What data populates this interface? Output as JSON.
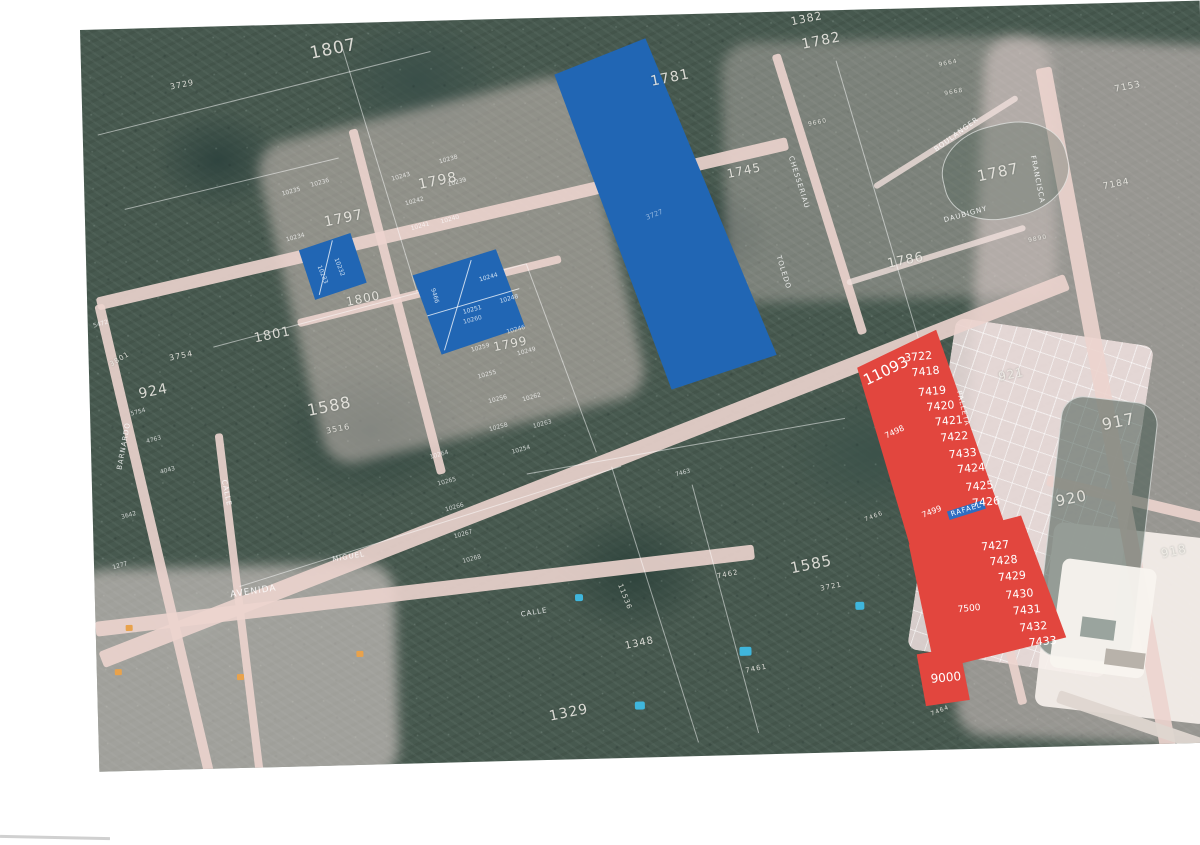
{
  "colors": {
    "highlight_red": "#e2463e",
    "highlight_blue": "#2166b4",
    "road_pink": "#ecd4ce",
    "street_banner_blue": "#2e6ec2",
    "label_white": "#ffffff",
    "forest_green": "#47594f"
  },
  "highlights": {
    "blue_parcels": {
      "large_parcel": "3727",
      "small_group_a": [
        "10233",
        "10232"
      ],
      "small_group_b": [
        "9466",
        "10244",
        "10251",
        "10248"
      ]
    },
    "red_parcels": {
      "side_labels": [
        "11093",
        "7498",
        "7499",
        "7500"
      ],
      "upper_column": [
        "3722",
        "7418",
        "7419",
        "7420",
        "7421",
        "7422",
        "7433",
        "7424",
        "7425",
        "7426"
      ],
      "lower_column": [
        "7427",
        "7428",
        "7429",
        "7430",
        "7431",
        "7432",
        "7433"
      ],
      "bottom_lot": "9000",
      "street_banner": "RAFAEL"
    }
  },
  "map_labels": [
    {
      "t": "1807",
      "k": "parcel",
      "x": 228,
      "y": 22,
      "s": 17
    },
    {
      "t": "3729",
      "k": "parcel",
      "x": 88,
      "y": 56,
      "s": 8
    },
    {
      "t": "1798",
      "k": "parcel",
      "x": 333,
      "y": 157,
      "s": 14
    },
    {
      "t": "1797",
      "k": "parcel",
      "x": 238,
      "y": 192,
      "s": 14
    },
    {
      "t": "1782",
      "k": "parcel",
      "x": 720,
      "y": 27,
      "s": 14
    },
    {
      "t": "1382",
      "k": "parcel",
      "x": 710,
      "y": 5,
      "s": 11
    },
    {
      "t": "1781",
      "k": "parcel",
      "x": 568,
      "y": 60,
      "s": 14
    },
    {
      "t": "1745",
      "k": "parcel",
      "x": 642,
      "y": 155,
      "s": 12
    },
    {
      "t": "1787",
      "k": "parcel",
      "x": 892,
      "y": 163,
      "s": 15
    },
    {
      "t": "1786",
      "k": "parcel",
      "x": 800,
      "y": 249,
      "s": 13
    },
    {
      "t": "7153",
      "k": "parcel",
      "x": 1032,
      "y": 83,
      "s": 9
    },
    {
      "t": "7184",
      "k": "parcel",
      "x": 1018,
      "y": 180,
      "s": 9
    },
    {
      "t": "917",
      "k": "parcel",
      "x": 1010,
      "y": 414,
      "s": 16
    },
    {
      "t": "921",
      "k": "parcel",
      "x": 908,
      "y": 365,
      "s": 12
    },
    {
      "t": "920",
      "k": "parcel",
      "x": 962,
      "y": 490,
      "s": 15
    },
    {
      "t": "918",
      "k": "parcel",
      "x": 1066,
      "y": 546,
      "s": 12
    },
    {
      "t": "924",
      "k": "parcel",
      "x": 48,
      "y": 359,
      "s": 14
    },
    {
      "t": "3754",
      "k": "parcel",
      "x": 80,
      "y": 327,
      "s": 8
    },
    {
      "t": "3801",
      "k": "parcel",
      "x": 20,
      "y": 333,
      "s": 7,
      "r": -30
    },
    {
      "t": "1801",
      "k": "parcel",
      "x": 165,
      "y": 307,
      "s": 13
    },
    {
      "t": "1800",
      "k": "parcel",
      "x": 258,
      "y": 273,
      "s": 12
    },
    {
      "t": "1799",
      "k": "parcel",
      "x": 404,
      "y": 322,
      "s": 12
    },
    {
      "t": "1588",
      "k": "parcel",
      "x": 216,
      "y": 379,
      "s": 16
    },
    {
      "t": "3516",
      "k": "parcel",
      "x": 235,
      "y": 404,
      "s": 8
    },
    {
      "t": "1585",
      "k": "parcel",
      "x": 695,
      "y": 550,
      "s": 15
    },
    {
      "t": "3721",
      "k": "parcel",
      "x": 725,
      "y": 575,
      "s": 7
    },
    {
      "t": "7462",
      "k": "parcel",
      "x": 622,
      "y": 560,
      "s": 7
    },
    {
      "t": "7461",
      "k": "parcel",
      "x": 648,
      "y": 655,
      "s": 7
    },
    {
      "t": "11536",
      "k": "parcel",
      "x": 528,
      "y": 567,
      "s": 7,
      "r": 70
    },
    {
      "t": "1329",
      "k": "parcel",
      "x": 450,
      "y": 692,
      "s": 14
    },
    {
      "t": "1348",
      "k": "parcel",
      "x": 528,
      "y": 626,
      "s": 10
    },
    {
      "t": "7464",
      "k": "parcel",
      "x": 832,
      "y": 704,
      "s": 6,
      "r": -20
    },
    {
      "t": "7466",
      "k": "parcel",
      "x": 771,
      "y": 508,
      "s": 6,
      "r": -20
    },
    {
      "t": "9890",
      "k": "parcel",
      "x": 942,
      "y": 233,
      "s": 6
    },
    {
      "t": "9664",
      "k": "parcel",
      "x": 857,
      "y": 55,
      "s": 6
    },
    {
      "t": "9668",
      "k": "parcel",
      "x": 862,
      "y": 84,
      "s": 6
    },
    {
      "t": "9660",
      "k": "parcel",
      "x": 725,
      "y": 111,
      "s": 6
    },
    {
      "t": "BOULANGER",
      "k": "street",
      "x": 850,
      "y": 140,
      "r": -35
    },
    {
      "t": "DAUBIGNY",
      "k": "street",
      "x": 858,
      "y": 210,
      "r": -14
    },
    {
      "t": "CHESSERIAU",
      "k": "street",
      "x": 710,
      "y": 144,
      "r": 74
    },
    {
      "t": "TOLEDO",
      "k": "street",
      "x": 695,
      "y": 243,
      "r": 74
    },
    {
      "t": "FRANCISCA",
      "k": "street",
      "x": 952,
      "y": 150,
      "r": 80
    },
    {
      "t": "PALLETA",
      "k": "street",
      "x": 872,
      "y": 383,
      "r": 78
    },
    {
      "t": "BARNARDO",
      "k": "street",
      "x": 25,
      "y": 440,
      "r": -78
    },
    {
      "t": "CALLE",
      "k": "street",
      "x": 135,
      "y": 453,
      "r": 80
    },
    {
      "t": "CALLE",
      "k": "street",
      "x": 425,
      "y": 593,
      "r": -8
    },
    {
      "t": "AVENIDA",
      "k": "street",
      "x": 135,
      "y": 565,
      "r": -7,
      "s": 9
    },
    {
      "t": "MIGUEL",
      "k": "street",
      "x": 238,
      "y": 533,
      "r": -8
    },
    {
      "t": "RAFAEL",
      "k": "banner",
      "x": 854,
      "y": 504,
      "r": -16
    },
    {
      "t": "10243",
      "k": "tiny",
      "x": 307,
      "y": 155
    },
    {
      "t": "10238",
      "k": "tiny",
      "x": 355,
      "y": 139
    },
    {
      "t": "10242",
      "k": "tiny",
      "x": 320,
      "y": 180
    },
    {
      "t": "10239",
      "k": "tiny",
      "x": 363,
      "y": 162
    },
    {
      "t": "10240",
      "k": "tiny",
      "x": 355,
      "y": 199
    },
    {
      "t": "10241",
      "k": "tiny",
      "x": 325,
      "y": 205
    },
    {
      "t": "10236",
      "k": "tiny",
      "x": 226,
      "y": 159
    },
    {
      "t": "10235",
      "k": "tiny",
      "x": 197,
      "y": 167
    },
    {
      "t": "10234",
      "k": "tiny",
      "x": 200,
      "y": 213
    },
    {
      "t": "10260",
      "k": "tiny",
      "x": 375,
      "y": 300
    },
    {
      "t": "10246",
      "k": "tiny",
      "x": 418,
      "y": 311
    },
    {
      "t": "10259",
      "k": "tiny",
      "x": 382,
      "y": 328
    },
    {
      "t": "10249",
      "k": "tiny",
      "x": 428,
      "y": 333
    },
    {
      "t": "10255",
      "k": "tiny",
      "x": 388,
      "y": 355
    },
    {
      "t": "10256",
      "k": "tiny",
      "x": 398,
      "y": 380
    },
    {
      "t": "10262",
      "k": "tiny",
      "x": 432,
      "y": 379
    },
    {
      "t": "10258",
      "k": "tiny",
      "x": 398,
      "y": 408
    },
    {
      "t": "10263",
      "k": "tiny",
      "x": 442,
      "y": 406
    },
    {
      "t": "10254",
      "k": "tiny",
      "x": 420,
      "y": 431
    },
    {
      "t": "10264",
      "k": "tiny",
      "x": 338,
      "y": 434
    },
    {
      "t": "10265",
      "k": "tiny",
      "x": 345,
      "y": 461
    },
    {
      "t": "10266",
      "k": "tiny",
      "x": 352,
      "y": 487
    },
    {
      "t": "10267",
      "k": "tiny",
      "x": 360,
      "y": 514
    },
    {
      "t": "10268",
      "k": "tiny",
      "x": 368,
      "y": 539
    },
    {
      "t": "5754",
      "k": "tiny",
      "x": 40,
      "y": 383
    },
    {
      "t": "4763",
      "k": "tiny",
      "x": 55,
      "y": 411
    },
    {
      "t": "4043",
      "k": "tiny",
      "x": 68,
      "y": 442
    },
    {
      "t": "3642",
      "k": "tiny",
      "x": 28,
      "y": 486
    },
    {
      "t": "1277",
      "k": "tiny",
      "x": 18,
      "y": 536
    },
    {
      "t": "5472",
      "k": "tiny",
      "x": 5,
      "y": 294
    },
    {
      "t": "7463",
      "k": "tiny",
      "x": 583,
      "y": 458
    },
    {
      "t": "3727",
      "k": "blue-lot",
      "x": 560,
      "y": 200,
      "s": 7,
      "r": -20,
      "c": "#8fb3dd"
    },
    {
      "t": "9466",
      "k": "blue-lot",
      "x": 348,
      "y": 267,
      "r": 75
    },
    {
      "t": "10244",
      "k": "blue-lot",
      "x": 392,
      "y": 258
    },
    {
      "t": "10251",
      "k": "blue-lot",
      "x": 375,
      "y": 290
    },
    {
      "t": "10248",
      "k": "blue-lot",
      "x": 412,
      "y": 280
    },
    {
      "t": "10233",
      "k": "blue-lot",
      "x": 235,
      "y": 241,
      "r": 70
    },
    {
      "t": "10232",
      "k": "blue-lot",
      "x": 252,
      "y": 234,
      "r": 70
    },
    {
      "t": "11093",
      "k": "red-lot",
      "x": 772,
      "y": 365,
      "s": 15,
      "r": -24
    },
    {
      "t": "7498",
      "k": "red-lot",
      "x": 793,
      "y": 424,
      "s": 8,
      "r": -24
    },
    {
      "t": "7499",
      "k": "red-lot",
      "x": 828,
      "y": 504,
      "s": 8,
      "r": -20
    },
    {
      "t": "7500",
      "k": "red-lot",
      "x": 862,
      "y": 599,
      "s": 9
    },
    {
      "t": "3722",
      "k": "red-lot",
      "x": 815,
      "y": 344
    },
    {
      "t": "7418",
      "k": "red-lot",
      "x": 822,
      "y": 359
    },
    {
      "t": "7419",
      "k": "red-lot",
      "x": 828,
      "y": 379
    },
    {
      "t": "7420",
      "k": "red-lot",
      "x": 836,
      "y": 394
    },
    {
      "t": "7421",
      "k": "red-lot",
      "x": 844,
      "y": 409
    },
    {
      "t": "7422",
      "k": "red-lot",
      "x": 849,
      "y": 425
    },
    {
      "t": "7433",
      "k": "red-lot",
      "x": 857,
      "y": 442
    },
    {
      "t": "7424",
      "k": "red-lot",
      "x": 865,
      "y": 457
    },
    {
      "t": "7425",
      "k": "red-lot",
      "x": 873,
      "y": 475
    },
    {
      "t": "7426",
      "k": "red-lot",
      "x": 879,
      "y": 491
    },
    {
      "t": "7427",
      "k": "red-lot",
      "x": 887,
      "y": 535
    },
    {
      "t": "7428",
      "k": "red-lot",
      "x": 895,
      "y": 550
    },
    {
      "t": "7429",
      "k": "red-lot",
      "x": 903,
      "y": 566
    },
    {
      "t": "7430",
      "k": "red-lot",
      "x": 910,
      "y": 584
    },
    {
      "t": "7431",
      "k": "red-lot",
      "x": 917,
      "y": 600
    },
    {
      "t": "7432",
      "k": "red-lot",
      "x": 923,
      "y": 617
    },
    {
      "t": "7433",
      "k": "red-lot",
      "x": 932,
      "y": 632
    },
    {
      "t": "9000",
      "k": "red-lot",
      "x": 833,
      "y": 665,
      "s": 12
    }
  ]
}
